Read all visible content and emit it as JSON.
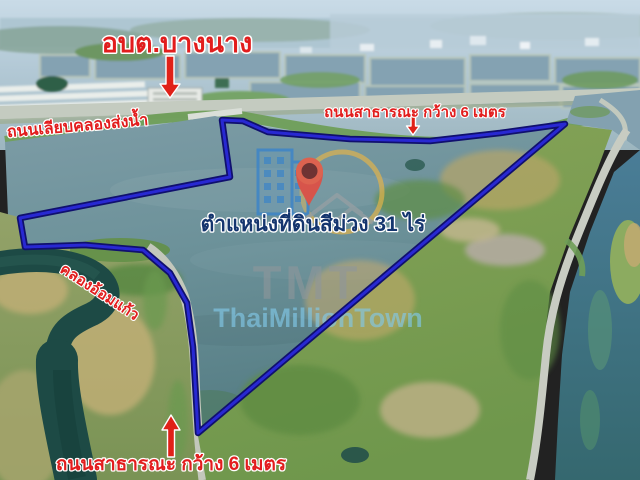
{
  "annotations": {
    "org_label": "อบต.บางนาง",
    "canal_road_label": "ถนนเลียบคลองส่งน้ำ",
    "public_road_top_label": "ถนนสาธารณะ กว้าง 6 เมตร",
    "position_label": "ตำแหน่งที่ดินสีม่วง 31 ไร่",
    "canal_label": "คลองอ้อมแก้ว",
    "public_road_bottom_label": "ถนนสาธารณะ กว้าง 6 เมตร",
    "red_label_color": "#e21d1d",
    "position_label_color": "#14356e",
    "boundary_color": "#2424cf"
  },
  "watermark": {
    "abbr": "TMT",
    "name": "ThaiMillionTown"
  }
}
